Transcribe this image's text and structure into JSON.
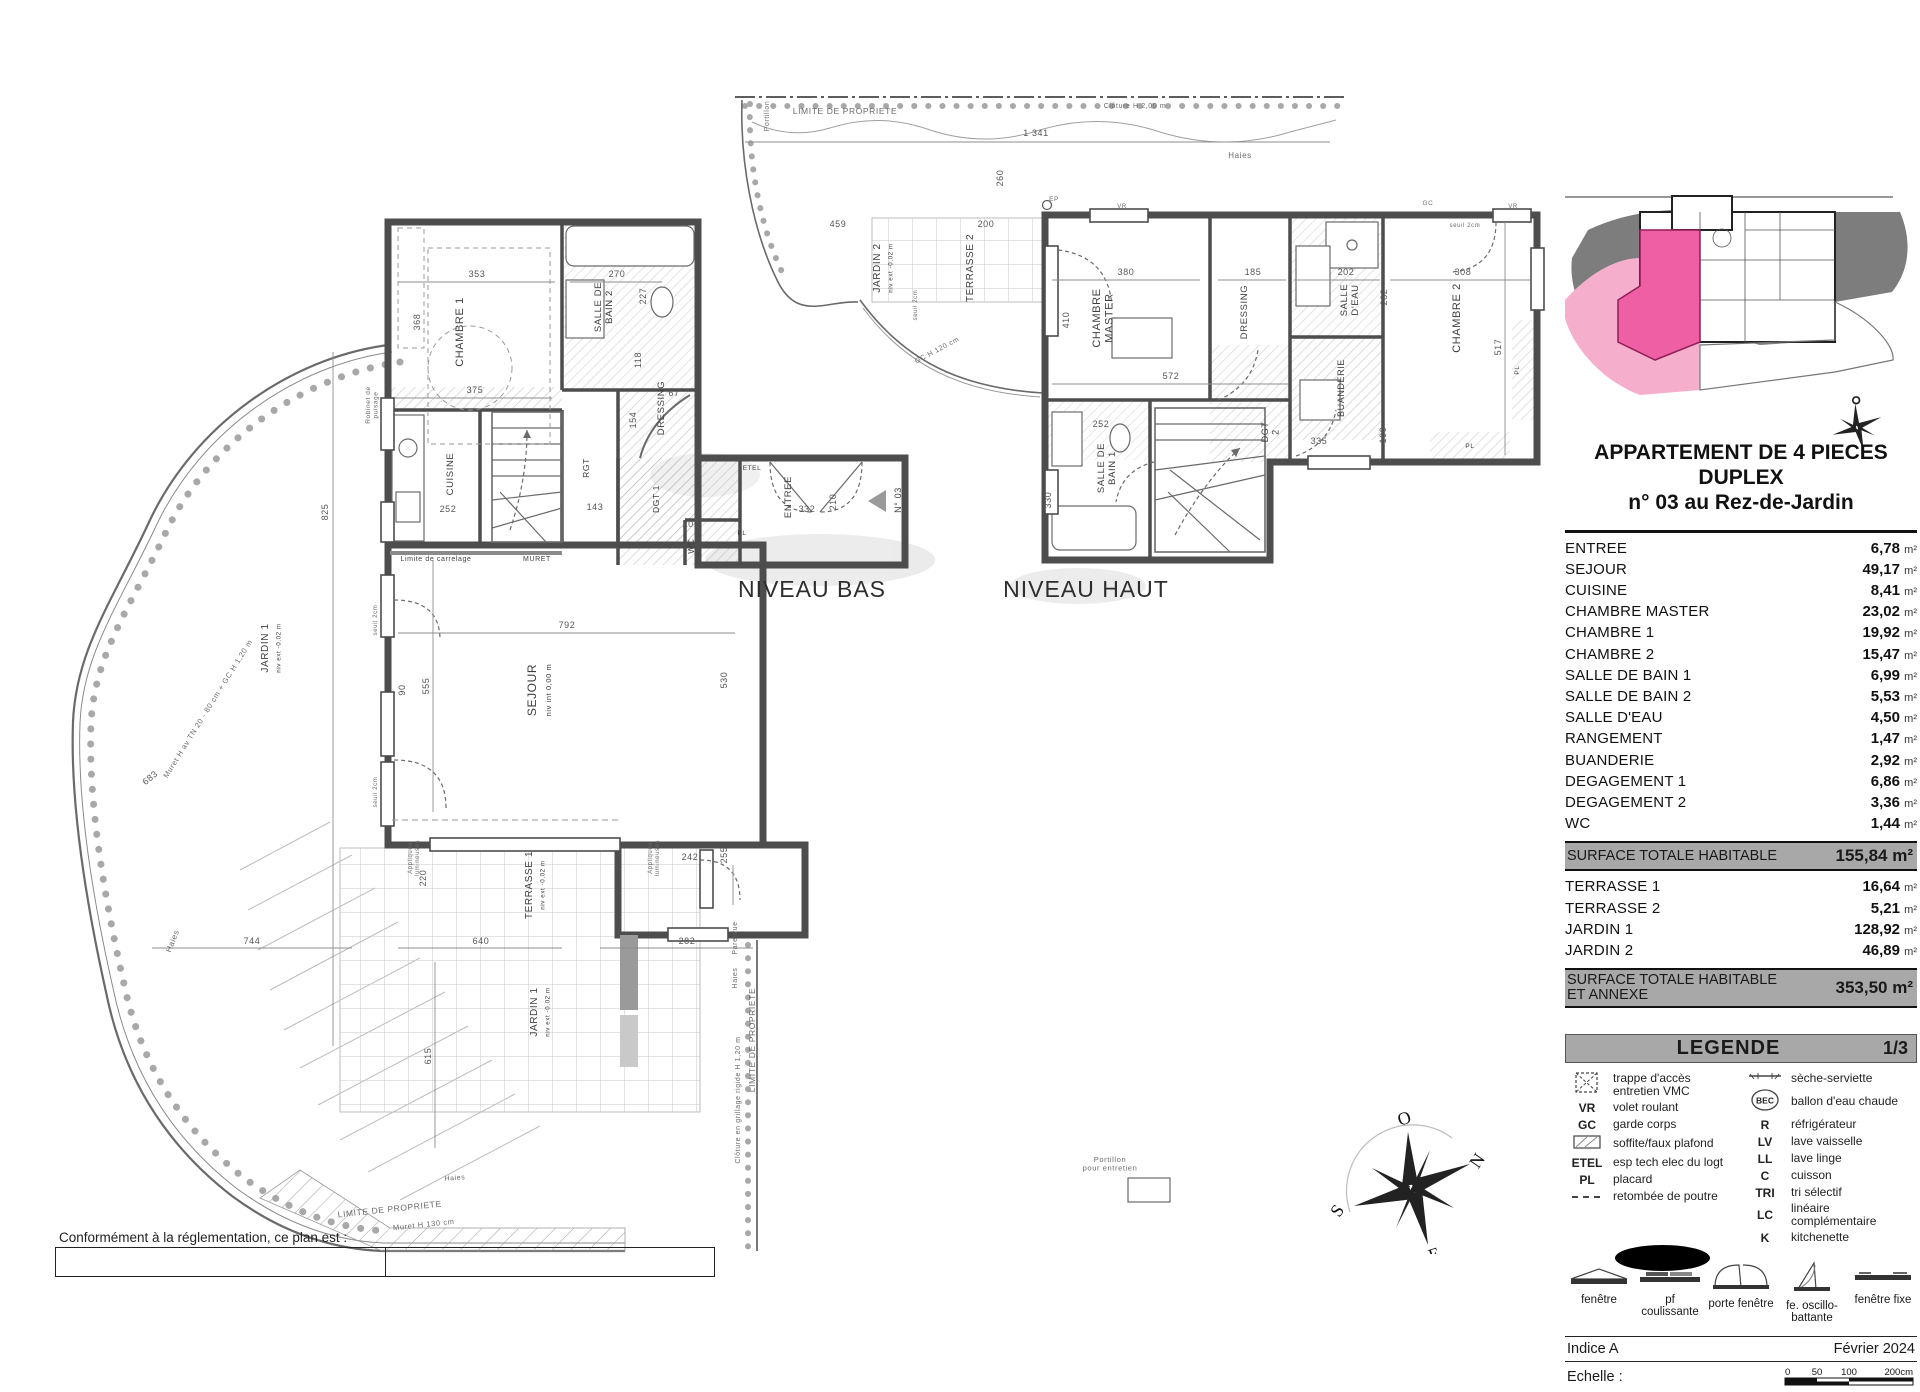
{
  "panel": {
    "title_line1": "APPARTEMENT DE 4 PIECES DUPLEX",
    "title_line2": "n° 03 au Rez-de-Jardin",
    "rooms": [
      {
        "name": "ENTREE",
        "value": "6,78",
        "unit": "m²"
      },
      {
        "name": "SEJOUR",
        "value": "49,17",
        "unit": "m²"
      },
      {
        "name": "CUISINE",
        "value": "8,41",
        "unit": "m²"
      },
      {
        "name": "CHAMBRE MASTER",
        "value": "23,02",
        "unit": "m²"
      },
      {
        "name": "CHAMBRE 1",
        "value": "19,92",
        "unit": "m²"
      },
      {
        "name": "CHAMBRE 2",
        "value": "15,47",
        "unit": "m²"
      },
      {
        "name": "SALLE DE BAIN 1",
        "value": "6,99",
        "unit": "m²"
      },
      {
        "name": "SALLE DE BAIN 2",
        "value": "5,53",
        "unit": "m²"
      },
      {
        "name": "SALLE D'EAU",
        "value": "4,50",
        "unit": "m²"
      },
      {
        "name": "RANGEMENT",
        "value": "1,47",
        "unit": "m²"
      },
      {
        "name": "BUANDERIE",
        "value": "2,92",
        "unit": "m²"
      },
      {
        "name": "DEGAGEMENT 1",
        "value": "6,86",
        "unit": "m²"
      },
      {
        "name": "DEGAGEMENT 2",
        "value": "3,36",
        "unit": "m²"
      },
      {
        "name": "WC",
        "value": "1,44",
        "unit": "m²"
      }
    ],
    "total_habitable": {
      "label": "SURFACE TOTALE HABITABLE",
      "value": "155,84 m²"
    },
    "annexes": [
      {
        "name": "TERRASSE 1",
        "value": "16,64",
        "unit": "m²"
      },
      {
        "name": "TERRASSE 2",
        "value": "5,21",
        "unit": "m²"
      },
      {
        "name": "JARDIN 1",
        "value": "128,92",
        "unit": "m²"
      },
      {
        "name": "JARDIN 2",
        "value": "46,89",
        "unit": "m²"
      }
    ],
    "total_annexe": {
      "label1": "SURFACE TOTALE HABITABLE",
      "label2": "ET ANNEXE",
      "value": "353,50 m²"
    },
    "legend": {
      "title": "LEGENDE",
      "page": "1/3",
      "left": [
        {
          "icon": "trappe",
          "label": "trappe d'accès\nentretien VMC"
        },
        {
          "abbr": "VR",
          "label": "volet roulant"
        },
        {
          "abbr": "GC",
          "label": "garde corps"
        },
        {
          "icon": "soffite",
          "label": "soffite/faux plafond"
        },
        {
          "abbr": "ETEL",
          "label": "esp tech elec  du logt"
        },
        {
          "abbr": "PL",
          "label": "placard"
        },
        {
          "icon": "poutre",
          "label": "retombée de poutre"
        }
      ],
      "right": [
        {
          "icon": "seche",
          "label": "sèche-serviette"
        },
        {
          "icon": "bec",
          "label": "ballon d'eau chaude"
        },
        {
          "abbr": "R",
          "label": "réfrigérateur"
        },
        {
          "abbr": "LV",
          "label": "lave vaisselle"
        },
        {
          "abbr": "LL",
          "label": "lave linge"
        },
        {
          "abbr": "C",
          "label": "cuisson"
        },
        {
          "abbr": "TRI",
          "label": "tri sélectif"
        },
        {
          "abbr": "LC",
          "label": "linéaire  complémentaire"
        },
        {
          "abbr": "K",
          "label": "kitchenette"
        }
      ],
      "bec_text": "BEC",
      "windows": [
        {
          "icon": "fenetre",
          "label": "fenêtre"
        },
        {
          "icon": "pf-coulissante",
          "label": "pf coulissante"
        },
        {
          "icon": "porte-fenetre",
          "label": "porte fenêtre"
        },
        {
          "icon": "oscillo-battante",
          "label": "fe. oscillo-battante"
        },
        {
          "icon": "fenetre-fixe",
          "label": "fenêtre fixe"
        }
      ]
    },
    "indice": "Indice A",
    "date": "Février 2024",
    "echelle_label": "Echelle :",
    "scale_ticks": [
      "0",
      "50",
      "100",
      "200cm"
    ]
  },
  "plan": {
    "niveau_bas_label": "NIVEAU BAS",
    "niveau_haut_label": "NIVEAU HAUT",
    "compass": {
      "top": "O",
      "right": "N",
      "left": "S",
      "bottom": "E"
    },
    "room_labels": [
      {
        "lines": [
          "CHAMBRE 1"
        ],
        "x": 463,
        "y": 332,
        "rot": -90,
        "size": 11
      },
      {
        "lines": [
          "SALLE DE",
          "BAIN 2"
        ],
        "x": 601,
        "y": 307,
        "rot": -90,
        "size": 9.5
      },
      {
        "lines": [
          "DRESSING"
        ],
        "x": 664,
        "y": 408,
        "rot": -90,
        "size": 9.5
      },
      {
        "lines": [
          "CUISINE"
        ],
        "x": 453,
        "y": 474,
        "rot": -90,
        "size": 9.5
      },
      {
        "lines": [
          "RGT"
        ],
        "x": 589,
        "y": 468,
        "rot": -90,
        "size": 8.5
      },
      {
        "lines": [
          "ENTREE"
        ],
        "x": 791,
        "y": 497,
        "rot": -90,
        "size": 9.5
      },
      {
        "lines": [
          "WC"
        ],
        "x": 694,
        "y": 546,
        "rot": -90,
        "size": 8.5
      },
      {
        "lines": [
          "DGT 1"
        ],
        "x": 659,
        "y": 499,
        "rot": -90,
        "size": 8.5
      },
      {
        "lines": [
          "ETEL"
        ],
        "x": 752,
        "y": 470,
        "rot": 0,
        "size": 6.5
      },
      {
        "lines": [
          "PL"
        ],
        "x": 742,
        "y": 535,
        "rot": 0,
        "size": 6.5
      },
      {
        "lines": [
          "SEJOUR"
        ],
        "sub": "niv int 0,00 m",
        "x": 536,
        "y": 690,
        "rot": -90,
        "size": 12
      },
      {
        "lines": [
          "MURET"
        ],
        "x": 537,
        "y": 561,
        "rot": 0,
        "size": 7
      },
      {
        "lines": [
          "Limite de carrelage"
        ],
        "x": 436,
        "y": 561,
        "rot": 0,
        "size": 7
      },
      {
        "lines": [
          "TERRASSE 1"
        ],
        "sub": "niv ext -0,02 m",
        "x": 532,
        "y": 885,
        "rot": -90,
        "size": 10
      },
      {
        "lines": [
          "JARDIN 1"
        ],
        "sub": "niv ext -0,02 m",
        "x": 268,
        "y": 648,
        "rot": -90,
        "size": 10
      },
      {
        "lines": [
          "JARDIN 1"
        ],
        "sub": "niv ext -0,02 m",
        "x": 537,
        "y": 1012,
        "rot": -90,
        "size": 10
      },
      {
        "lines": [
          "N° 03"
        ],
        "x": 901,
        "y": 500,
        "rot": -90,
        "size": 9
      },
      {
        "lines": [
          "JARDIN 2"
        ],
        "sub": "niv ext -0,02 m",
        "x": 880,
        "y": 268,
        "rot": -90,
        "size": 10
      },
      {
        "lines": [
          "TERRASSE 2"
        ],
        "x": 973,
        "y": 268,
        "rot": -90,
        "size": 10
      },
      {
        "lines": [
          "CHAMBRE",
          "MASTER"
        ],
        "x": 1100,
        "y": 318,
        "rot": -90,
        "size": 11
      },
      {
        "lines": [
          "DRESSING"
        ],
        "x": 1247,
        "y": 312,
        "rot": -90,
        "size": 9.5
      },
      {
        "lines": [
          "SALLE",
          "D'EAU"
        ],
        "x": 1347,
        "y": 300,
        "rot": -90,
        "size": 9.5
      },
      {
        "lines": [
          "BUANDERIE"
        ],
        "x": 1344,
        "y": 388,
        "rot": -90,
        "size": 9
      },
      {
        "lines": [
          "CHAMBRE 2"
        ],
        "x": 1460,
        "y": 318,
        "rot": -90,
        "size": 11
      },
      {
        "lines": [
          "SALLE DE",
          "BAIN 1"
        ],
        "x": 1104,
        "y": 468,
        "rot": -90,
        "size": 9.5
      },
      {
        "lines": [
          "DGT",
          "2"
        ],
        "x": 1268,
        "y": 432,
        "rot": -90,
        "size": 9
      },
      {
        "lines": [
          "PL"
        ],
        "x": 1519,
        "y": 370,
        "rot": -90,
        "size": 6.5
      },
      {
        "lines": [
          "PL"
        ],
        "x": 1470,
        "y": 448,
        "rot": 0,
        "size": 6.5
      }
    ],
    "dimensions": [
      {
        "t": "353",
        "x": 477,
        "y": 277,
        "r": 0
      },
      {
        "t": "270",
        "x": 617,
        "y": 277,
        "r": 0
      },
      {
        "t": "368",
        "x": 420,
        "y": 322,
        "r": -90
      },
      {
        "t": "227",
        "x": 646,
        "y": 296,
        "r": -90
      },
      {
        "t": "375",
        "x": 475,
        "y": 393,
        "r": 0
      },
      {
        "t": "118",
        "x": 641,
        "y": 360,
        "r": -90
      },
      {
        "t": "67",
        "x": 674,
        "y": 396,
        "r": 0
      },
      {
        "t": "154",
        "x": 636,
        "y": 420,
        "r": -90
      },
      {
        "t": "252",
        "x": 448,
        "y": 512,
        "r": 0
      },
      {
        "t": "143",
        "x": 595,
        "y": 510,
        "r": 0
      },
      {
        "t": "332",
        "x": 807,
        "y": 512,
        "r": 0
      },
      {
        "t": "210",
        "x": 836,
        "y": 502,
        "r": -90
      },
      {
        "t": "202",
        "x": 691,
        "y": 527,
        "r": 0
      },
      {
        "t": "792",
        "x": 567,
        "y": 628,
        "r": 0
      },
      {
        "t": "555",
        "x": 429,
        "y": 686,
        "r": -90
      },
      {
        "t": "530",
        "x": 727,
        "y": 680,
        "r": -90
      },
      {
        "t": "90",
        "x": 405,
        "y": 690,
        "r": -90
      },
      {
        "t": "220",
        "x": 426,
        "y": 878,
        "r": -90
      },
      {
        "t": "640",
        "x": 481,
        "y": 944,
        "r": 0
      },
      {
        "t": "282",
        "x": 687,
        "y": 944,
        "r": 0
      },
      {
        "t": "744",
        "x": 252,
        "y": 944,
        "r": 0
      },
      {
        "t": "615",
        "x": 431,
        "y": 1056,
        "r": -90
      },
      {
        "t": "825",
        "x": 328,
        "y": 512,
        "r": -90
      },
      {
        "t": "683",
        "x": 152,
        "y": 780,
        "r": -40
      },
      {
        "t": "242",
        "x": 690,
        "y": 860,
        "r": 0
      },
      {
        "t": "255",
        "x": 727,
        "y": 855,
        "r": -90
      },
      {
        "t": "1 341",
        "x": 1036,
        "y": 136,
        "r": 0
      },
      {
        "t": "260",
        "x": 1003,
        "y": 178,
        "r": -90
      },
      {
        "t": "459",
        "x": 838,
        "y": 227,
        "r": 0
      },
      {
        "t": "200",
        "x": 986,
        "y": 227,
        "r": 0
      },
      {
        "t": "380",
        "x": 1126,
        "y": 275,
        "r": 0
      },
      {
        "t": "185",
        "x": 1253,
        "y": 275,
        "r": 0
      },
      {
        "t": "202",
        "x": 1346,
        "y": 275,
        "r": 0
      },
      {
        "t": "308",
        "x": 1463,
        "y": 275,
        "r": 0
      },
      {
        "t": "410",
        "x": 1069,
        "y": 320,
        "r": -90
      },
      {
        "t": "282",
        "x": 1387,
        "y": 297,
        "r": -90
      },
      {
        "t": "517",
        "x": 1501,
        "y": 347,
        "r": -90
      },
      {
        "t": "572",
        "x": 1171,
        "y": 379,
        "r": 0
      },
      {
        "t": "252",
        "x": 1101,
        "y": 427,
        "r": 0
      },
      {
        "t": "335",
        "x": 1319,
        "y": 444,
        "r": 0
      },
      {
        "t": "100",
        "x": 1386,
        "y": 435,
        "r": -90
      },
      {
        "t": "330",
        "x": 1051,
        "y": 500,
        "r": -90
      }
    ],
    "annotations": [
      {
        "lines": [
          "LIMITE DE PROPRIETE"
        ],
        "x": 845,
        "y": 114,
        "r": 0,
        "s": 8.5
      },
      {
        "lines": [
          "Clôture H 2,00 m"
        ],
        "x": 1135,
        "y": 108,
        "r": 0,
        "s": 7
      },
      {
        "lines": [
          "Haies"
        ],
        "x": 1240,
        "y": 158,
        "r": 0,
        "s": 8
      },
      {
        "lines": [
          "Portillon"
        ],
        "x": 769,
        "y": 116,
        "r": -90,
        "s": 7
      },
      {
        "lines": [
          "EP"
        ],
        "x": 1054,
        "y": 201,
        "r": 0,
        "s": 6.5
      },
      {
        "lines": [
          "GC"
        ],
        "x": 1428,
        "y": 205,
        "r": 0,
        "s": 6.5
      },
      {
        "lines": [
          "VR"
        ],
        "x": 1122,
        "y": 208,
        "r": 0,
        "s": 6
      },
      {
        "lines": [
          "VR"
        ],
        "x": 1513,
        "y": 208,
        "r": 0,
        "s": 6
      },
      {
        "lines": [
          "seuil 2cm"
        ],
        "x": 1465,
        "y": 227,
        "r": 0,
        "s": 6
      },
      {
        "lines": [
          "GC H 120 cm"
        ],
        "x": 938,
        "y": 352,
        "r": -28,
        "s": 7
      },
      {
        "lines": [
          "Muret H av TN 20 - 80 cm + GC H 1,20 m"
        ],
        "x": 210,
        "y": 710,
        "r": -58,
        "s": 7.5
      },
      {
        "lines": [
          "Haies"
        ],
        "x": 175,
        "y": 942,
        "r": -68,
        "s": 8
      },
      {
        "lines": [
          "LIMITE DE PROPRIETE"
        ],
        "x": 390,
        "y": 1212,
        "r": -6,
        "s": 8.5
      },
      {
        "lines": [
          "Muret H 130 cm"
        ],
        "x": 424,
        "y": 1227,
        "r": -6,
        "s": 7.5
      },
      {
        "lines": [
          "Pare-vue"
        ],
        "x": 737,
        "y": 938,
        "r": -90,
        "s": 7
      },
      {
        "lines": [
          "Haies"
        ],
        "x": 737,
        "y": 978,
        "r": -90,
        "s": 7
      },
      {
        "lines": [
          "LIMITE DE PROPRIETE"
        ],
        "x": 755,
        "y": 1040,
        "r": -90,
        "s": 8.5
      },
      {
        "lines": [
          "Clôture en grillage rigide H 1,20 m"
        ],
        "x": 740,
        "y": 1100,
        "r": -90,
        "s": 7
      },
      {
        "lines": [
          "Portillon",
          "pour entretien"
        ],
        "x": 1110,
        "y": 1162,
        "r": 0,
        "s": 7.5
      },
      {
        "lines": [
          "Robinet de",
          "puisage"
        ],
        "x": 370,
        "y": 405,
        "r": -90,
        "s": 6.5
      },
      {
        "lines": [
          "Appliques",
          "lumineuses"
        ],
        "x": 412,
        "y": 858,
        "r": -90,
        "s": 6
      },
      {
        "lines": [
          "Appliques",
          "lumineuses"
        ],
        "x": 652,
        "y": 858,
        "r": -90,
        "s": 6
      },
      {
        "lines": [
          "seuil 2cm"
        ],
        "x": 377,
        "y": 620,
        "r": -90,
        "s": 6
      },
      {
        "lines": [
          "seuil 2cm"
        ],
        "x": 377,
        "y": 792,
        "r": -90,
        "s": 6
      },
      {
        "lines": [
          "seuil 2cm"
        ],
        "x": 917,
        "y": 305,
        "r": -90,
        "s": 6
      },
      {
        "lines": [
          "Haies"
        ],
        "x": 455,
        "y": 1180,
        "r": -4,
        "s": 7
      }
    ]
  },
  "footer": {
    "conformity": "Conformément à la réglementation, ce plan est :"
  }
}
